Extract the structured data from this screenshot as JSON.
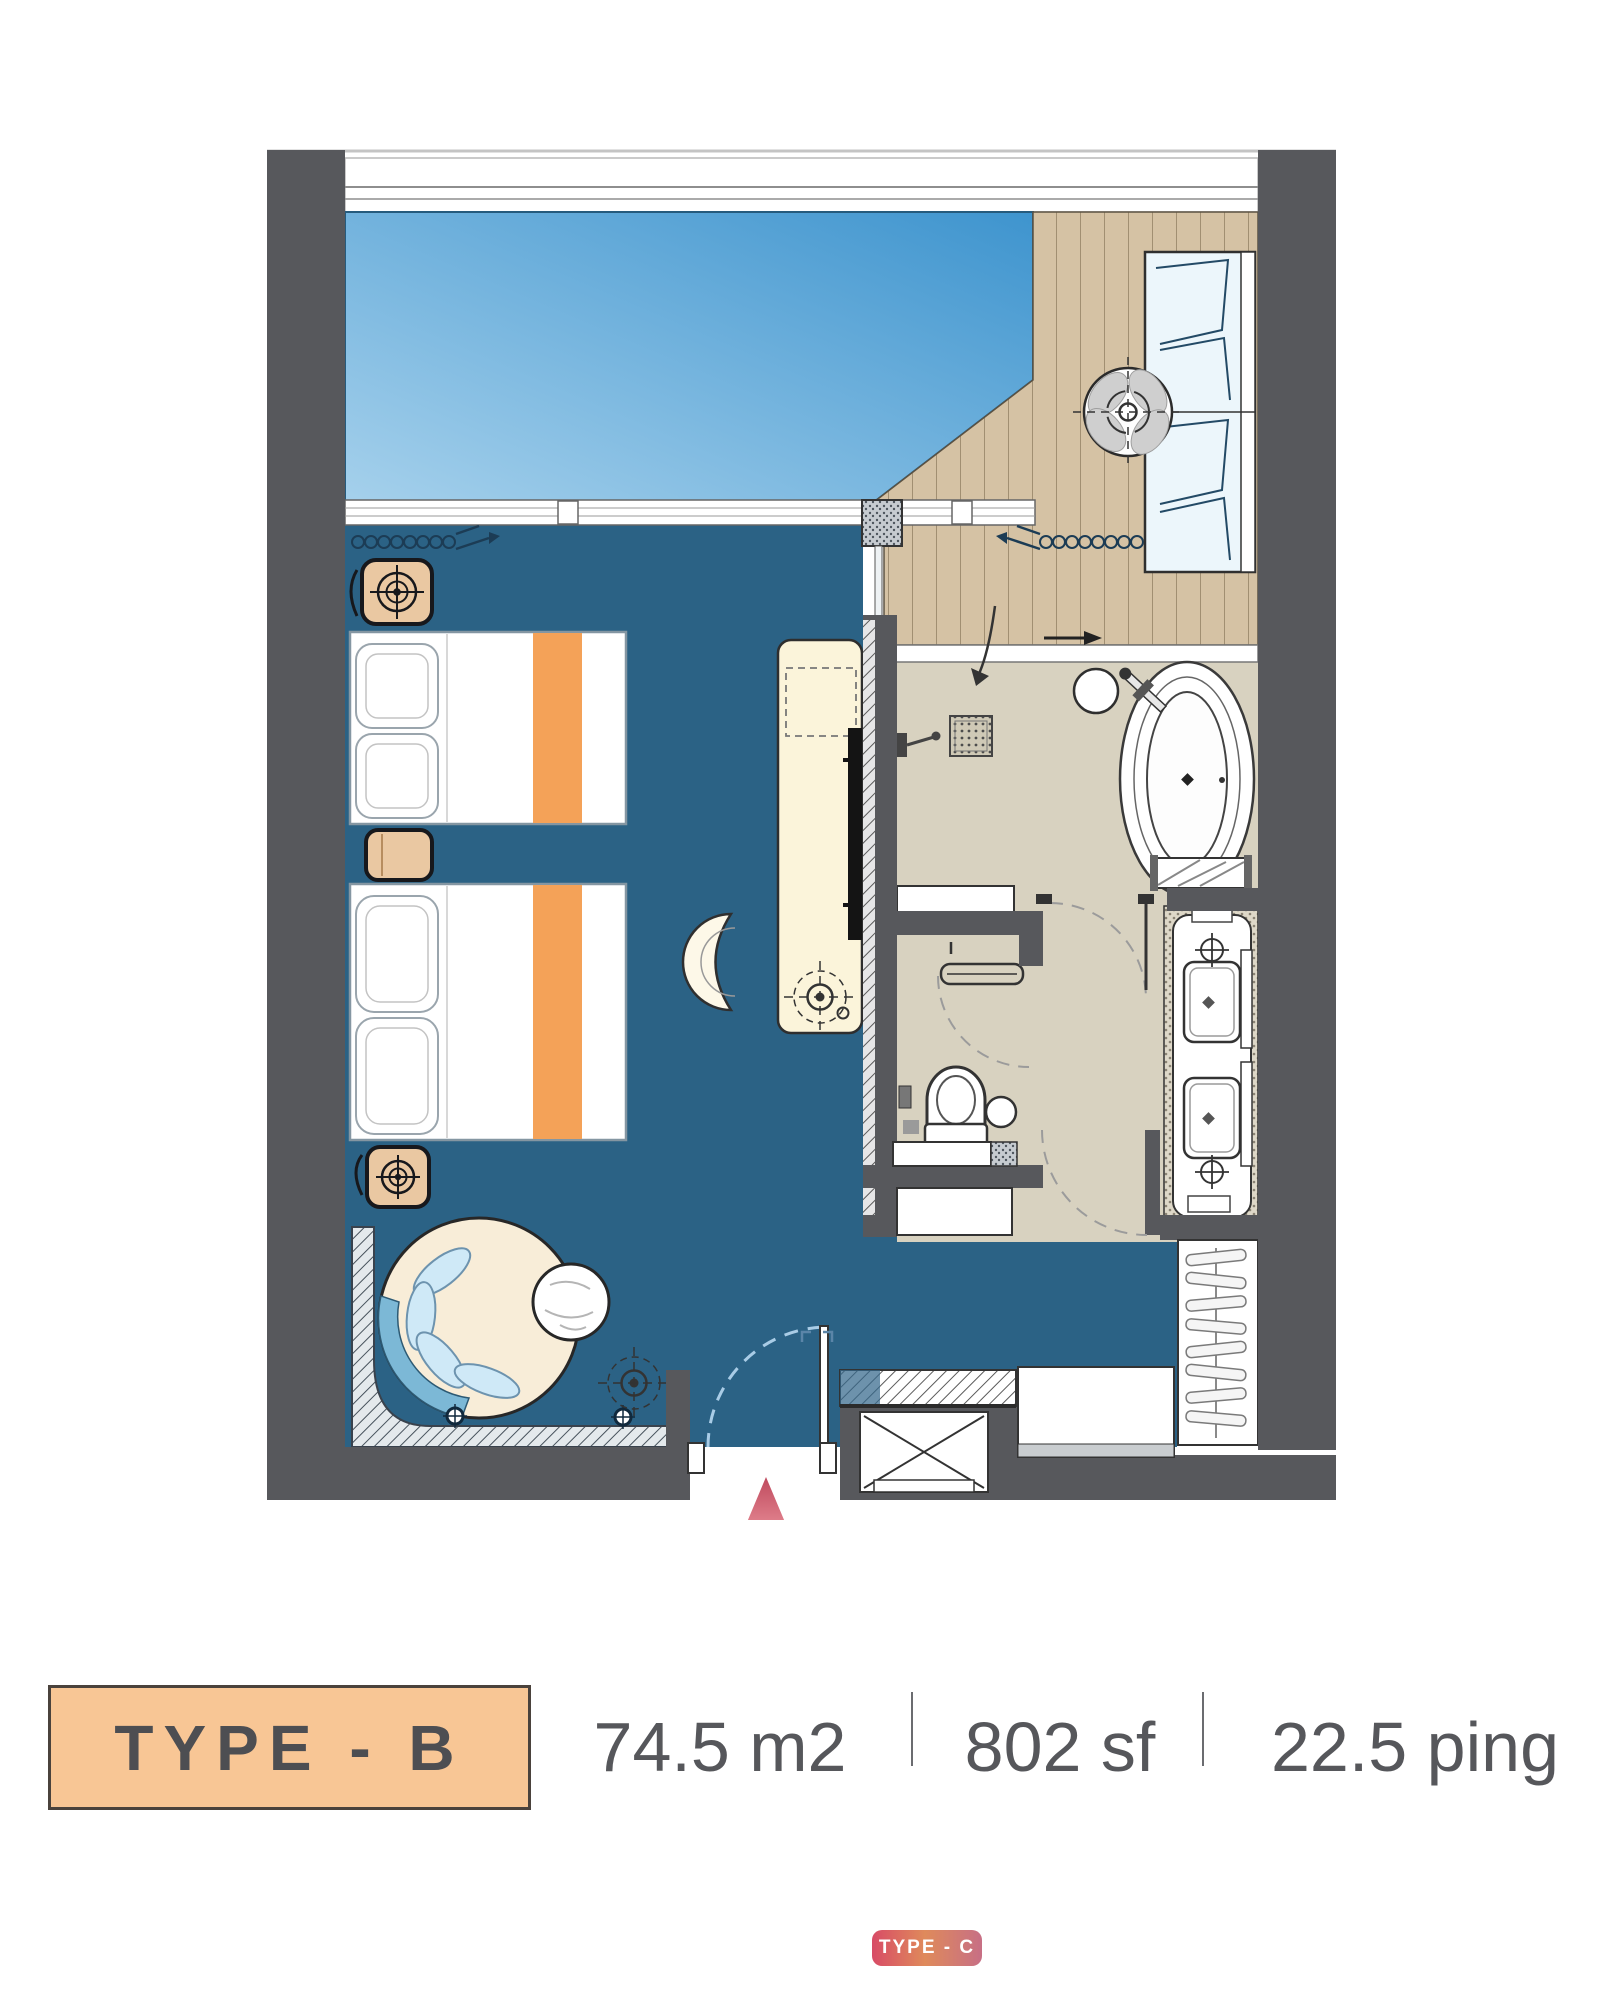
{
  "footer": {
    "type_label": "TYPE - B",
    "area_m2": "74.5 m2",
    "area_sf": "802 sf",
    "area_ping": "22.5 ping"
  },
  "badge": {
    "label": "TYPE - C"
  },
  "plan": {
    "colors": {
      "wall": "#57585c",
      "bedroom_floor": "#2b6285",
      "pool_gradient": [
        "#a3cfeb",
        "#3e94ce"
      ],
      "wood_deck": "#d5c2a4",
      "bath_floor": "#d8d2c0",
      "accent_orange": "#f4a258",
      "furniture_cream": "#fbf4da",
      "nightstand_tan": "#eac8a2",
      "cushion_blue": "#cfe9f7",
      "label_box": "#f8c695",
      "north_arrow": [
        "#bf4a5e",
        "#f09aa2"
      ],
      "badge_gradient": [
        "#d84b66",
        "#df8a5b",
        "#c76f85"
      ]
    },
    "icons": [
      "pool",
      "wood-deck",
      "daybed",
      "deck-planter-icon",
      "curtain-icon",
      "nightstand",
      "ceiling-fan-icon",
      "twin-bed",
      "double-bed",
      "tv-console",
      "tv",
      "desk-chair",
      "ceiling-light-icon",
      "round-lounge-chair",
      "side-table",
      "corner-bench",
      "shower-mixer-icon",
      "floor-drain-icon",
      "bathtub",
      "bath-stool",
      "towel-rack",
      "toilet",
      "towel-bar",
      "double-sink-vanity",
      "faucet-icon",
      "mirror",
      "wardrobe",
      "luggage-rack",
      "minibar-cabinet",
      "service-shaft",
      "entry-door",
      "north-arrow-icon"
    ]
  }
}
